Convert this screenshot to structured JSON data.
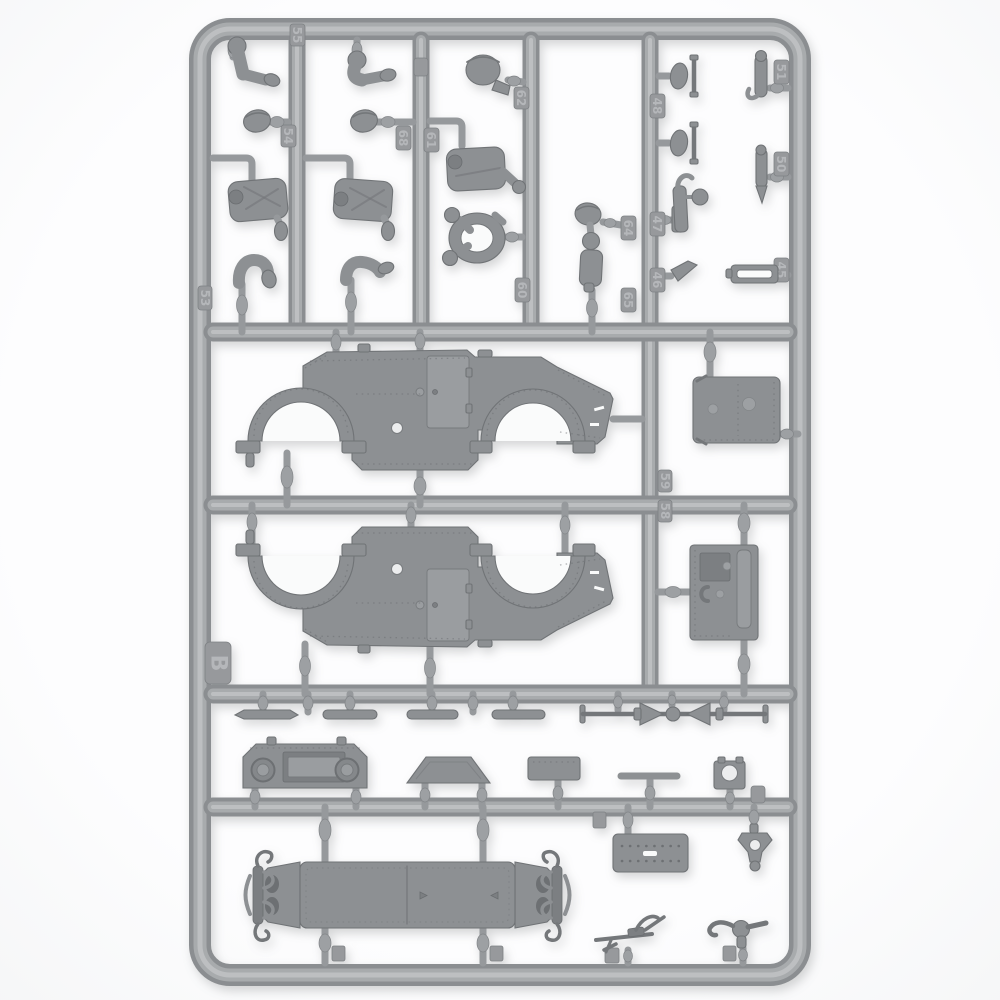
{
  "photo": {
    "subject": "Unassembled gray plastic injection-molded model kit sprue (parts frame) photographed on a white background",
    "kit_theme": "WWII armored car: hull side panels, chassis floor, doors, leaf springs, levers and crew figure parts",
    "background_color": "#fbfcfd",
    "plastic_color": "#a8abad",
    "part_color": "#8d9093",
    "shadow_color": "#6d7073"
  },
  "sprue": {
    "letter": "B",
    "tags": [
      {
        "label": "55"
      },
      {
        "label": "54"
      },
      {
        "label": "53"
      },
      {
        "label": "68"
      },
      {
        "label": "61"
      },
      {
        "label": "62"
      },
      {
        "label": "60"
      },
      {
        "label": "64"
      },
      {
        "label": "65"
      },
      {
        "label": "48"
      },
      {
        "label": "47"
      },
      {
        "label": "46"
      },
      {
        "label": "51"
      },
      {
        "label": "50"
      },
      {
        "label": "45"
      },
      {
        "label": "59"
      },
      {
        "label": "58"
      }
    ],
    "parts": [
      {
        "name": "bent-arm-upper",
        "desc": "crew figure bent arms, top row",
        "count": 2
      },
      {
        "name": "figure-head",
        "desc": "bare crew heads",
        "count": 2
      },
      {
        "name": "figure-torso",
        "desc": "crew torsos with field gear and hanging pouch",
        "count": 2
      },
      {
        "name": "bent-arm-lower",
        "desc": "crew bent arms, third row",
        "count": 2
      },
      {
        "name": "helmeted-head",
        "desc": "head with helmet and shoulder stub",
        "count": 1
      },
      {
        "name": "gunner-torso",
        "desc": "torso with extended right fist",
        "count": 1
      },
      {
        "name": "steering-wheel-arms",
        "desc": "pair of arms holding a steering wheel ring",
        "count": 1
      },
      {
        "name": "small-head",
        "desc": "small crew head",
        "count": 1
      },
      {
        "name": "shift-figure",
        "desc": "small ball-top lever with boot",
        "count": 1
      },
      {
        "name": "foot-pedal",
        "desc": "pedal pads with T-bar",
        "count": 2
      },
      {
        "name": "hand-brake-lever",
        "desc": "lever with ball knob and hooked top",
        "count": 1
      },
      {
        "name": "small-lever-blade",
        "desc": "small angled lever blade",
        "count": 1
      },
      {
        "name": "gear-lever",
        "desc": "hooked gear lever",
        "count": 1
      },
      {
        "name": "pointed-lever",
        "desc": "lever with pointed tip",
        "count": 1
      },
      {
        "name": "bracket-frame",
        "desc": "open rectangular bracket",
        "count": 1
      },
      {
        "name": "hull-side-upper",
        "desc": "armored hull side with two fender arches, hatch door and tail plate",
        "count": 1
      },
      {
        "name": "hull-side-lower",
        "desc": "matching hull side panel, molded inverted",
        "count": 1
      },
      {
        "name": "roof-panel",
        "desc": "riveted rectangular panel with two domed bolts",
        "count": 1
      },
      {
        "name": "side-door",
        "desc": "riveted door with vision port, handle and hinge strip",
        "count": 1
      },
      {
        "name": "leaf-spring",
        "desc": "flat leaf-spring strips",
        "count": 4
      },
      {
        "name": "dashboard",
        "desc": "instrument panel with two round gauges",
        "count": 1
      },
      {
        "name": "windshield-visor",
        "desc": "trapezoid visor plate",
        "count": 1
      },
      {
        "name": "small-plate",
        "desc": "small rectangular plate",
        "count": 1
      },
      {
        "name": "steering-linkage",
        "desc": "long rod with rubber boots and center ball joint",
        "count": 1
      },
      {
        "name": "tie-rod",
        "desc": "short straight rod",
        "count": 1
      },
      {
        "name": "axle-block",
        "desc": "block with round opening",
        "count": 1
      },
      {
        "name": "chassis-floor",
        "desc": "long chassis floor with leaf-sprung axle mounts at both ends",
        "count": 1
      },
      {
        "name": "perforated-plate",
        "desc": "plate with two rows of holes and a center slot",
        "count": 1
      },
      {
        "name": "tow-shackle",
        "desc": "shackle bracket with ball end",
        "count": 1
      },
      {
        "name": "machine-gun",
        "desc": "small machine gun with curved magazine",
        "count": 1
      },
      {
        "name": "gear-stick",
        "desc": "ball-joint lever assembly",
        "count": 1
      }
    ]
  }
}
